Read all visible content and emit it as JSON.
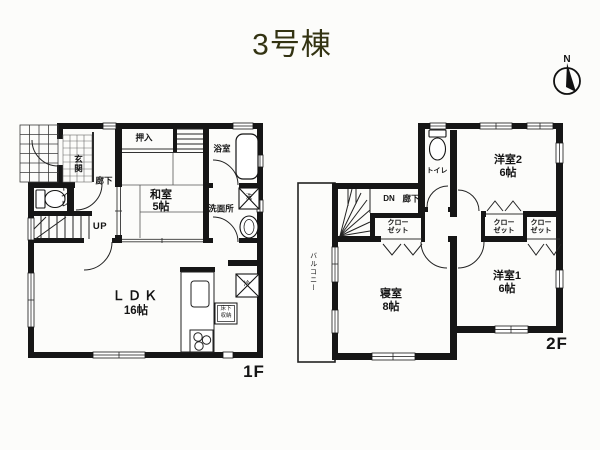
{
  "title": "3号棟",
  "compass": {
    "north": "N"
  },
  "floor1": {
    "label": "1F",
    "entrance": "玄関",
    "hallway": "廊下",
    "oshiire": "押入",
    "japanese_room": {
      "name": "和室",
      "size": "5帖"
    },
    "bathroom": "浴室",
    "washroom": "洗面所",
    "toilet": "トイレ",
    "stairs": "UP",
    "ldk": {
      "name": "ＬＤＫ",
      "size": "16帖"
    },
    "underfloor_storage": {
      "line1": "床下",
      "line2": "収納"
    },
    "washer_mark": "洗",
    "fridge_mark": "冷"
  },
  "floor2": {
    "label": "2F",
    "toilet": "トイレ",
    "western_room2": {
      "name": "洋室2",
      "size": "6帖"
    },
    "stairs": "DN",
    "hallway": "廊下",
    "closet": {
      "line1": "クロー",
      "line2": "ゼット"
    },
    "bedroom": {
      "name": "寝室",
      "size": "8帖"
    },
    "western_room1": {
      "name": "洋室1",
      "size": "6帖"
    },
    "balcony": "バルコニー"
  }
}
